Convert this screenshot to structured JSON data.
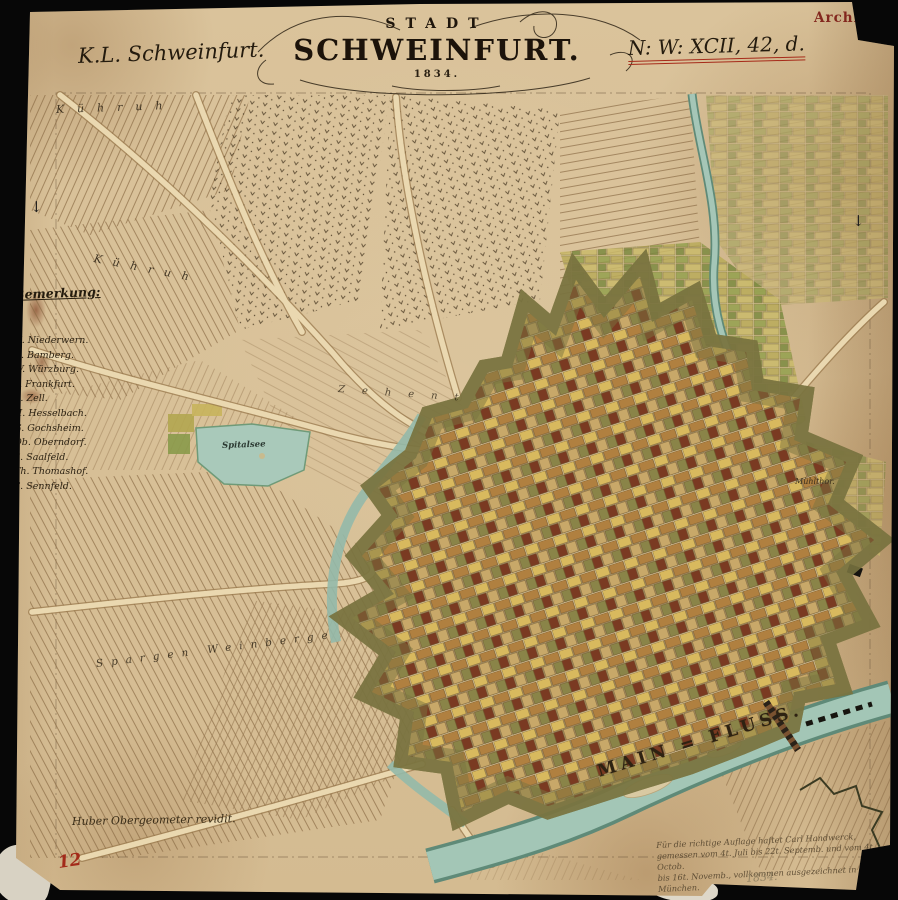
{
  "map": {
    "title": {
      "kicker": "STADT",
      "name": "SCHWEINFURT.",
      "year": "1834."
    },
    "annotations": {
      "top_left": "K.L. Schweinfurt.",
      "catalog_ref": "N: W: XCII, 42, d.",
      "archive_stamp": "Archiv"
    },
    "legend": {
      "heading": "Bemerkung:",
      "items": [
        "N. Niederwern.",
        "B. Bamberg.",
        "W. Würzburg.",
        "F. Frankfurt.",
        "Z. Zell.",
        "H. Hesselbach.",
        "G. Gochsheim.",
        "Ob. Oberndorf.",
        "S. Saalfeld.",
        "Th. Thomashof.",
        "S. Sennfeld."
      ]
    },
    "place_labels": {
      "field_top": "Kühruh",
      "field_mid": "Kühruh",
      "field_strip": "Zehent",
      "pond": "Spitalsee",
      "gate_east": "Mühlthor.",
      "river": "MAIN = FLUSS.",
      "vineyard": "Spargen Weinberge"
    },
    "marginalia": {
      "surveyor_note": "Huber Obergeometer revidit.",
      "certification": [
        "Für die richtige Auflage haftet Carl Handwerck,",
        "gemessen vom 4t. Juli bis 22t. Septemb. und vom 4t. Octob.",
        "bis 16t. Novemb., vollkommen ausgezeichnet in München."
      ],
      "certification_year": "1834.",
      "inventory_number": "12",
      "edge_mark_left": "↓",
      "edge_mark_right": "↓"
    },
    "colors": {
      "paper": "#d8c096",
      "ink": "#241b0e",
      "red_ink": "#a32a1a",
      "stamp_red": "#7a1812",
      "river": "#9fc3b4",
      "fortress": "#3f3d22",
      "city_block_yellow": "#d8b95e",
      "background": "#070707"
    }
  }
}
